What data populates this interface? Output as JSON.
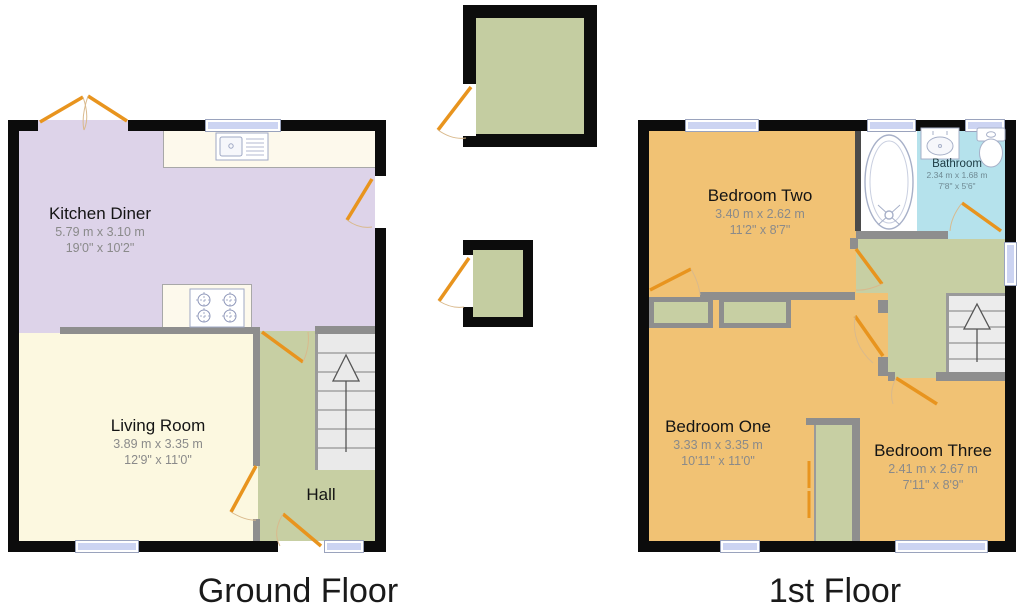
{
  "ground_floor": {
    "label": "Ground Floor",
    "kitchen_diner": {
      "name": "Kitchen Diner",
      "metric": "5.79 m x 3.10 m",
      "imperial": "19'0\" x 10'2\""
    },
    "living_room": {
      "name": "Living Room",
      "metric": "3.89 m x 3.35 m",
      "imperial": "12'9\" x 11'0\""
    },
    "hall": {
      "name": "Hall"
    }
  },
  "first_floor": {
    "label": "1st Floor",
    "bedroom_two": {
      "name": "Bedroom Two",
      "metric": "3.40 m x 2.62 m",
      "imperial": "11'2\" x 8'7\""
    },
    "bathroom": {
      "name": "Bathroom",
      "metric": "2.34 m x 1.68 m",
      "imperial": "7'8\" x 5'6\""
    },
    "bedroom_one": {
      "name": "Bedroom One",
      "metric": "3.33 m x 3.35 m",
      "imperial": "10'11\" x 11'0\""
    },
    "bedroom_three": {
      "name": "Bedroom Three",
      "metric": "2.41 m x 2.67 m",
      "imperial": "7'11\" x 8'9\""
    }
  },
  "colors": {
    "exterior_wall": "#0c0c0c",
    "interior_wall": "#8e8e8e",
    "kitchen_floor": "#ddd3e9",
    "living_floor": "#fcf8e0",
    "hall_landing_floor": "#c7cfa3",
    "bedroom_floor": "#f1c274",
    "bathroom_floor": "#b5e2ec",
    "outbuilding_floor": "#c4cda1",
    "door": "#e8941e",
    "window": "#ccd4f2",
    "stairs": "#eaeaea"
  }
}
